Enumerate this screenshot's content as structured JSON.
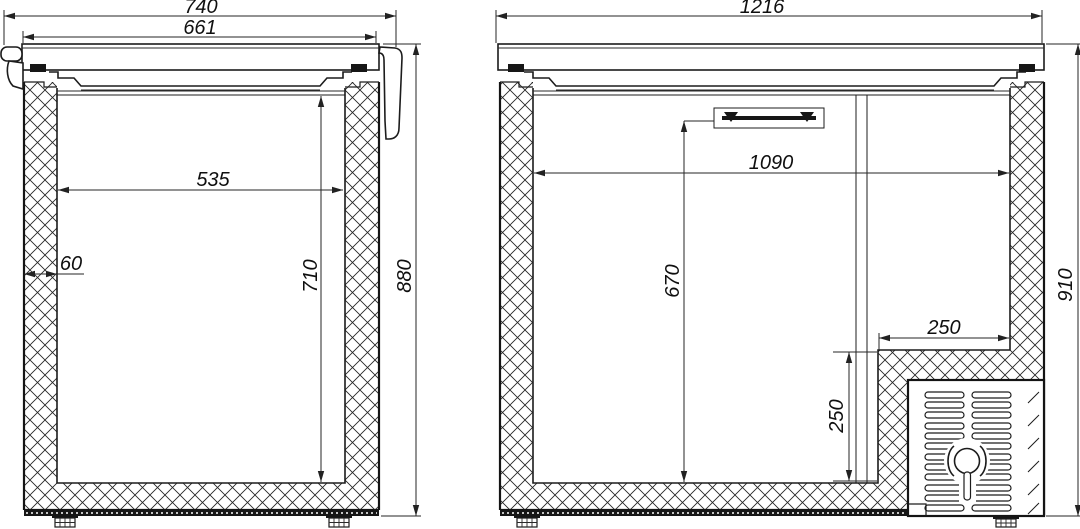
{
  "page": {
    "background": "#ffffff",
    "line_color": "#1c1c1c"
  },
  "drawing": {
    "type": "technical-cross-section",
    "views": [
      {
        "name": "small-chest-freezer-section",
        "dimensions": {
          "overall_width": "740",
          "lid_width": "661",
          "interior_width": "535",
          "wall_thickness": "60",
          "interior_height": "710",
          "overall_height": "880"
        }
      },
      {
        "name": "large-chest-freezer-section",
        "dimensions": {
          "overall_width": "1216",
          "interior_width": "1090",
          "interior_height": "670",
          "niche_width": "250",
          "niche_height": "250",
          "overall_height": "910"
        }
      }
    ]
  }
}
